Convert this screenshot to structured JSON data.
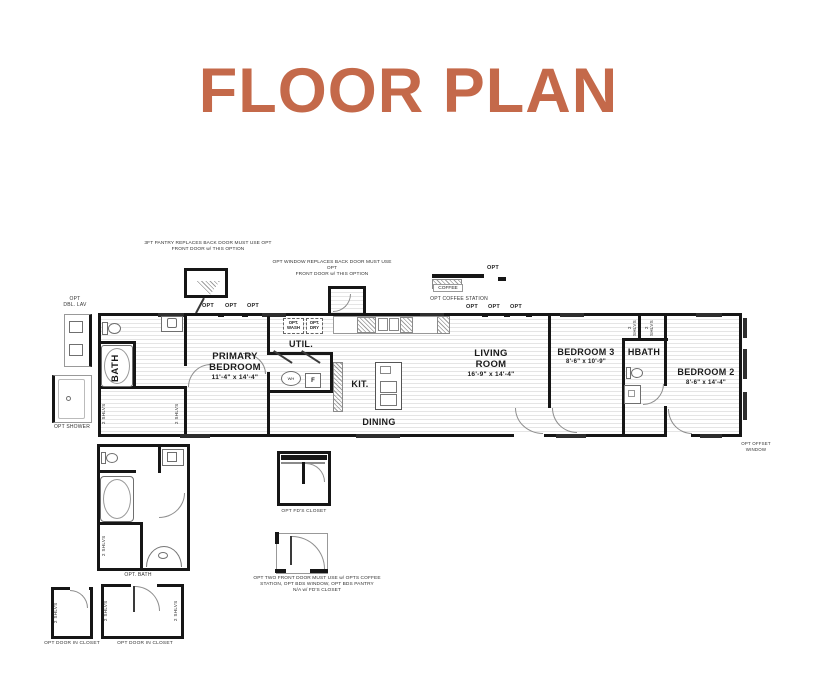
{
  "title": "FLOOR PLAN",
  "colors": {
    "accent": "#C4694A",
    "line": "#161616"
  },
  "plan": {
    "rooms": {
      "bath": {
        "name": "BATH"
      },
      "primary_bedroom": {
        "name": "PRIMARY\nBEDROOM",
        "dims": "11'-4\" x  14'-4\""
      },
      "util": {
        "name": "UTIL."
      },
      "kitchen": {
        "name": "KIT."
      },
      "dining": {
        "name": "DINING"
      },
      "living_room": {
        "name": "LIVING\nROOM",
        "dims": "16'-9\" x  14'-4\""
      },
      "bedroom3": {
        "name": "BEDROOM 3",
        "dims": "8'-6\" x  10'-9\""
      },
      "hbath": {
        "name": "HBATH"
      },
      "bedroom2": {
        "name": "BEDROOM 2",
        "dims": "8'-6\" x  14'-4\""
      }
    },
    "fixtures": {
      "wash": "OPT.\nWASH",
      "dry": "OPT.\nDRY",
      "fridge": "F",
      "water_heater": "WH"
    },
    "labels": {
      "opt": "OPT",
      "shelves": "2 SHLVS"
    },
    "options": {
      "pantry_note": "3FT PANTRY REPLACES BACK DOOR MUST USE OPT\nFRONT DOOR w/ THIS OPTION",
      "window_note": "OPT WINDOW REPLACES BACK DOOR MUST USE OPT\nFRONT DOOR w/ THIS OPTION",
      "dbl_lav": "OPT\nDBL. LAV",
      "shower": "OPT SHOWER",
      "coffee": "COFFEE",
      "coffee_station": "OPT COFFEE STATION",
      "opt_bath": "OPT. BATH",
      "fds_closet": "OPT FD'S CLOSET",
      "front_door_note": "OPT TWO FRONT DOOR MUST USE w/ OPTS COFFEE\nSTATION, OPT BDS WINDOW, OPT BDS PANTRY\nN/A w/ FD'S CLOSET",
      "door_in_closet_1": "OPT DOOR IN CLOSET",
      "door_in_closet_2": "OPT DOOR IN CLOSET",
      "offset_window": "OPT OFFSET\nWINDOW"
    }
  }
}
